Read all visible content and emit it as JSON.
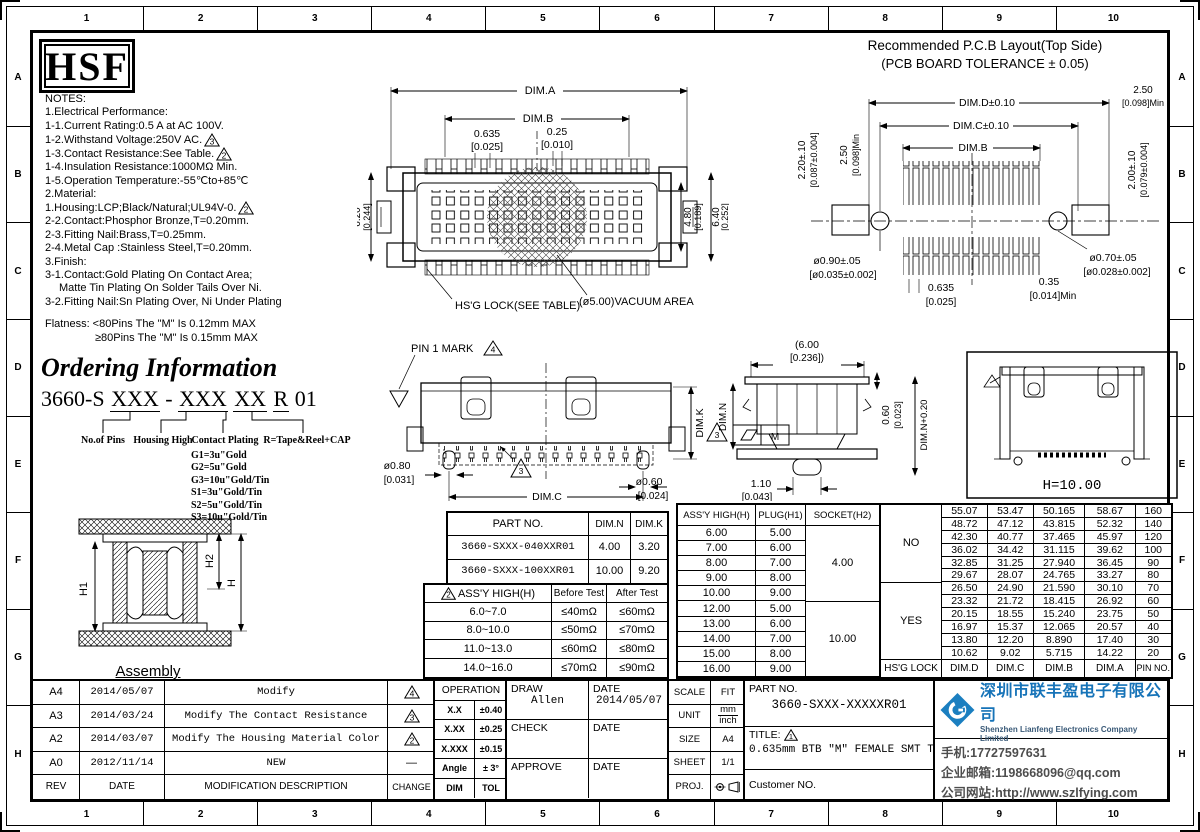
{
  "rulers": {
    "top": [
      "1",
      "2",
      "3",
      "4",
      "5",
      "6",
      "7",
      "8",
      "9",
      "10"
    ],
    "side": [
      "A",
      "B",
      "C",
      "D",
      "E",
      "F",
      "G",
      "H"
    ]
  },
  "logo": "HSF",
  "notes": {
    "lines": [
      "NOTES:",
      "1.Electrical Performance:",
      "1-1.Current Rating:0.5 A at AC 100V.",
      "1-2.Withstand Voltage:250V AC.",
      "1-3.Contact Resistance:See Table.",
      "1-4.Insulation Resistance:1000MΩ Min.",
      "1-5.Operation Temperature:-55℃to+85℃",
      "2.Material:",
      "1.Housing:LCP;Black/Natural;UL94V-0.",
      "2-2.Contact:Phosphor Bronze,T=0.20mm.",
      "2-3.Fitting Nail:Brass,T=0.25mm.",
      "2-4.Metal Cap :Stainless Steel,T=0.20mm.",
      "3.Finish:",
      "3-1.Contact:Gold Plating On Contact Area;",
      "Matte Tin Plating On Solder Tails Over Ni.",
      "3-2.Fitting Nail:Sn Plating Over, Ni Under Plating"
    ],
    "tri_withstand": "3",
    "tri_contact": "2",
    "tri_housing": "2",
    "flatness1": "Flatness: <80Pins The \"M\" Is 0.12mm MAX",
    "flatness2": "≥80Pins The \"M\" Is 0.15mm MAX"
  },
  "ordering": {
    "title": "Ordering Information",
    "code_prefix": "3660-S",
    "code_p1": "XXX",
    "code_dash": "-",
    "code_p2": "XXX",
    "code_p3": "XX",
    "code_p4": "R",
    "code_suffix": "01",
    "label_pins": "No.of Pins",
    "label_housing": "Housing High",
    "label_plating": "Contact Plating",
    "label_reel": "R=Tape&Reel+CAP",
    "plating_options": [
      "G1=3u\"Gold",
      "G2=5u\"Gold",
      "G3=10u\"Gold/Tin",
      "S1=3u\"Gold/Tin",
      "S2=5u\"Gold/Tin",
      "S3=10u\"Gold/Tin"
    ]
  },
  "assembly": {
    "h1": "H1",
    "h2": "H2",
    "h": "H",
    "caption": "Assembly"
  },
  "front_view": {
    "dim_a": "DIM.A",
    "dim_b": "DIM.B",
    "pitch": "0.635",
    "pitch_in": "[0.025]",
    "pad": "0.25",
    "pad_in": "[0.010]",
    "height_left": "6.20",
    "height_left_in": "[0.244]",
    "height_mid": "4.80",
    "height_mid_in": "[0.189]",
    "height_right": "6.40",
    "height_right_in": "[0.252]",
    "lock_note": "HS'G LOCK(SEE TABLE)",
    "vacuum_note": "(ø5.00)VACUUM AREA"
  },
  "pcb": {
    "title1": "Recommended P.C.B Layout(Top Side)",
    "title2": "(PCB BOARD TOLERANCE ± 0.05)",
    "dim_d": "DIM.D±0.10",
    "dim_c": "DIM.C±0.10",
    "dim_b": "DIM.B",
    "min_top_left": "2.50",
    "min_top_left_in": "[0.098]Min",
    "outer_left": "2.20±.10",
    "outer_left_in": "[0.087±0.004]",
    "min_top_right": "2.50",
    "min_top_right_in": "[0.098]Min",
    "outer_right": "2.00±.10",
    "outer_right_in": "[0.079±0.004]",
    "hole_left": "ø0.90±.05",
    "hole_left_in": "[ø0.035±0.002]",
    "hole_right": "ø0.70±.05",
    "hole_right_in": "[ø0.028±0.002]",
    "pitch": "0.635",
    "pitch_in": "[0.025]",
    "pad": "0.35",
    "pad_in": "[0.014]Min"
  },
  "side_view": {
    "pin1": "PIN 1 MARK",
    "pin1_tri": "4",
    "dim_k": "DIM.K",
    "dia_left": "ø0.80",
    "dia_left_in": "[0.031]",
    "dia_right": "ø0.60",
    "dia_right_in": "[0.024]",
    "dim_c": "DIM.C",
    "tri": "3"
  },
  "profile": {
    "width": "(6.00",
    "width_in": "[0.236])",
    "dim_n": "DIM.N",
    "cap": "0.60",
    "cap_in": "[0.023]",
    "dim_n20": "DIM.N+0.20",
    "boss": "1.10",
    "boss_in": "[0.043]",
    "tri": "3",
    "flat_m": "M"
  },
  "hbox": {
    "label": "H=10.00"
  },
  "part_table": {
    "h_part": "PART NO.",
    "h_n": "DIM.N",
    "h_k": "DIM.K",
    "rows": [
      {
        "part": "3660-SXXX-040XXR01",
        "n": "4.00",
        "k": "3.20"
      },
      {
        "part": "3660-SXXX-100XXR01",
        "n": "10.00",
        "k": "9.20"
      }
    ]
  },
  "resistance_table": {
    "tri": "2",
    "h_high": "ASS'Y HIGH(H)",
    "h_before": "Before Test",
    "h_after": "After Test",
    "rows": [
      {
        "high": "6.0~7.0",
        "before": "≤40mΩ",
        "after": "≤60mΩ"
      },
      {
        "high": "8.0~10.0",
        "before": "≤50mΩ",
        "after": "≤70mΩ"
      },
      {
        "high": "11.0~13.0",
        "before": "≤60mΩ",
        "after": "≤80mΩ"
      },
      {
        "high": "14.0~16.0",
        "before": "≤70mΩ",
        "after": "≤90mΩ"
      }
    ]
  },
  "assy_table": {
    "h_assy": "ASS'Y HIGH(H)",
    "h_plug": "PLUG(H1)",
    "h_socket": "SOCKET(H2)",
    "assy": [
      "6.00",
      "7.00",
      "8.00",
      "9.00",
      "10.00",
      "12.00",
      "13.00",
      "14.00",
      "15.00",
      "16.00"
    ],
    "plug": [
      "5.00",
      "6.00",
      "7.00",
      "8.00",
      "9.00",
      "5.00",
      "6.00",
      "7.00",
      "8.00",
      "9.00"
    ],
    "socket_a": "4.00",
    "socket_b": "10.00"
  },
  "pin_table": {
    "lock_no": "NO",
    "lock_yes": "YES",
    "f_lock": "HS'G LOCK",
    "f_d": "DIM.D",
    "f_c": "DIM.C",
    "f_b": "DIM.B",
    "f_a": "DIM.A",
    "f_pin": "PIN NO.",
    "dim_d": [
      "55.07",
      "48.72",
      "42.30",
      "36.02",
      "32.85",
      "29.67",
      "26.50",
      "23.32",
      "20.15",
      "16.97",
      "13.80",
      "10.62"
    ],
    "dim_c": [
      "53.47",
      "47.12",
      "40.77",
      "34.42",
      "31.25",
      "28.07",
      "24.90",
      "21.72",
      "18.55",
      "15.37",
      "12.20",
      "9.02"
    ],
    "dim_b": [
      "50.165",
      "43.815",
      "37.465",
      "31.115",
      "27.940",
      "24.765",
      "21.590",
      "18.415",
      "15.240",
      "12.065",
      "8.890",
      "5.715"
    ],
    "dim_a": [
      "58.67",
      "52.32",
      "45.97",
      "39.62",
      "36.45",
      "33.27",
      "30.10",
      "26.92",
      "23.75",
      "20.57",
      "17.40",
      "14.22"
    ],
    "pin_no": [
      "160",
      "140",
      "120",
      "100",
      "90",
      "80",
      "70",
      "60",
      "50",
      "40",
      "30",
      "20"
    ]
  },
  "revisions": {
    "rows": [
      {
        "rev": "A4",
        "date": "2014/05/07",
        "desc": "Modify",
        "tri": "4"
      },
      {
        "rev": "A3",
        "date": "2014/03/24",
        "desc": "Modify The Contact Resistance",
        "tri": "3"
      },
      {
        "rev": "A2",
        "date": "2014/03/07",
        "desc": "Modify The Housing Material Color",
        "tri": "2"
      },
      {
        "rev": "A0",
        "date": "2012/11/14",
        "desc": "NEW",
        "dash": "—"
      }
    ],
    "f_rev": "REV",
    "f_date": "DATE",
    "f_desc": "MODIFICATION DESCRIPTION",
    "f_change": "CHANGE"
  },
  "operation": {
    "header": "OPERATION",
    "rows": [
      {
        "dim": "X.X",
        "tol": "±0.40"
      },
      {
        "dim": "X.XX",
        "tol": "±0.25"
      },
      {
        "dim": "X.XXX",
        "tol": "±0.15"
      },
      {
        "dim": "Angle",
        "tol": "± 3°"
      }
    ],
    "f_dim": "DIM",
    "f_tol": "TOL"
  },
  "approval": {
    "draw_label": "DRAW",
    "draw_name": "Allen",
    "date_label": "DATE",
    "draw_date": "2014/05/07",
    "check_label": "CHECK",
    "approve_label": "APPROVE"
  },
  "info": {
    "scale_label": "SCALE",
    "scale": "FIT",
    "unit_label": "UNIT",
    "unit_mm": "mm",
    "unit_inch": "inch",
    "size_label": "SIZE",
    "size": "A4",
    "sheet_label": "SHEET",
    "sheet": "1/1",
    "proj_label": "PROJ."
  },
  "part_block": {
    "part_label": "PART NO.",
    "part_no": "3660-SXXX-XXXXXR01",
    "title_label": "TITLE:",
    "title_tri": "1",
    "title": "0.635mm BTB \"M\" FEMALE SMT TYPE",
    "customer_label": "Customer NO."
  },
  "company": {
    "name_cn": "深圳市联丰盈电子有限公司",
    "name_en": "Shenzhen Lianfeng Electronics Company Limited",
    "phone": "手机:17727597631",
    "email": "企业邮箱:1198668096@qq.com",
    "website": "公司网站:http://www.szlfying.com",
    "brand_blue": "#1b7fc0"
  }
}
